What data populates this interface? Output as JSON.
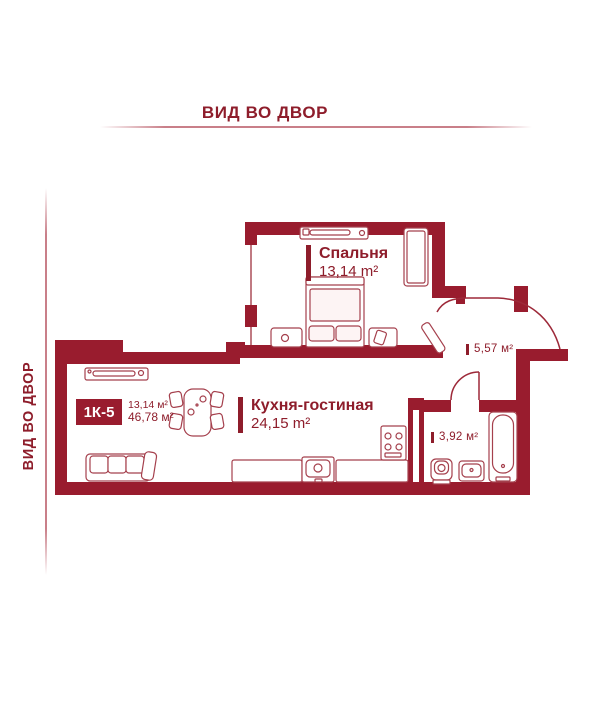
{
  "colors": {
    "wall": "#991c2e",
    "label": "#8e1d2b",
    "furniture": "#a5404d",
    "rule_line": "#c97f89",
    "badge_text": "#ffffff"
  },
  "header": {
    "top_label": "ВИД ВО ДВОР",
    "side_label": "ВИД ВО ДВОР"
  },
  "unit": {
    "badge": "1К-5",
    "area_living": "13,14 м²",
    "area_total": "46,78 м²"
  },
  "rooms": {
    "bedroom": {
      "name": "Спальня",
      "area": "13,14 m²"
    },
    "kitchen": {
      "name": "Кухня-гостиная",
      "area": "24,15 m²"
    },
    "hallway": {
      "area": "5,57 м²"
    },
    "bathroom": {
      "area": "3,92 м²"
    }
  }
}
